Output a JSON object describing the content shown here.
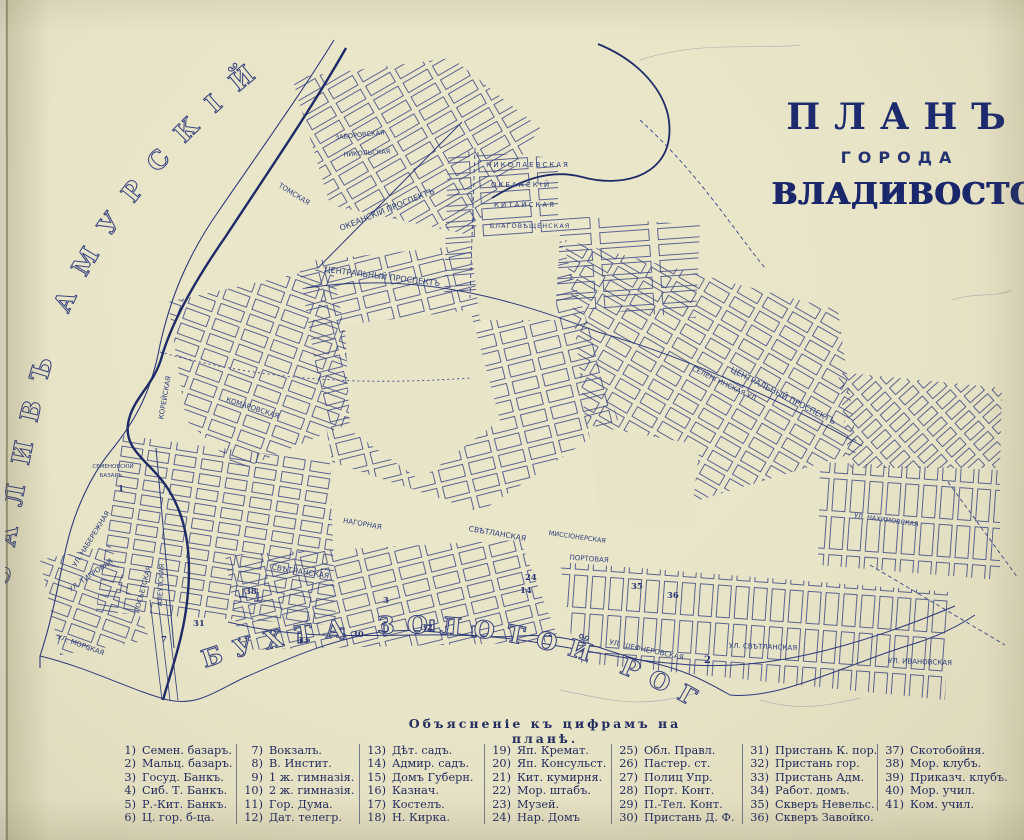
{
  "title": {
    "plan": "ПЛАНЪ",
    "goroda": "ГОРОДА",
    "city": "ВЛАДИВОСТОКА"
  },
  "colors": {
    "paper": "#e8e4c7",
    "ink": "#2e3a7a",
    "ink_dark": "#1f2b66"
  },
  "water": {
    "amur_bay": "ЗАЛИВЪ  АМУРСКІЙ",
    "golden_horn": "БУХТА  ЗОЛОТОЙ  РОГЪ"
  },
  "map": {
    "streets": [
      "ОКЕАНСКІЙ ПРОСПЕКТЪ",
      "ЦЕНТРАЛЬНЫЙ ПРОСПЕКТЪ",
      "СВѢТЛАНСКАЯ",
      "УЛ. СВѢТЛАНСКАЯ",
      "АЛЕУТСКАЯ",
      "КОРЕЙСКАЯ",
      "УЛ. НАБЕРЕЖНАЯ",
      "УЛ. ТИГРОВАЯ",
      "ПОСЬЕТСКАЯ",
      "КОМАРОВСКАЯ",
      "ТОМСКАЯ",
      "КИТАЙСКАЯ",
      "НИКОЛАЕВСКАЯ",
      "ОКЕАНСКІЙ",
      "БЛАГОВѢЩЕНСКАЯ",
      "ЗАБОРОВСКАЯ",
      "НИКОЛЬСКАЯ",
      "СЕЛЕНГИНСКАЯ УЛ.",
      "ПОРТОВАЯ",
      "НАГОРНАЯ",
      "МИССІОНЕРСКАЯ",
      "УЛ. ШЕФНЕРОВСКАЯ",
      "УЛ. ИВАНОВСКАЯ",
      "УЛ. МОРСКАЯ",
      "СЕМЕНОВСКІЙ",
      "БАЗАРЪ",
      "УЛ. НАХИМОВСКАЯ"
    ],
    "markers": [
      "1",
      "2",
      "3",
      "7",
      "14",
      "24",
      "30",
      "31",
      "32",
      "33",
      "35",
      "36",
      "38"
    ]
  },
  "legend": {
    "heading": "Объясненіе къ цифрамъ на планѣ.",
    "items": [
      {
        "n": "1)",
        "t": "Семен. базаръ."
      },
      {
        "n": "2)",
        "t": "Мальц. базаръ."
      },
      {
        "n": "3)",
        "t": "Госуд. Банкъ."
      },
      {
        "n": "4)",
        "t": "Сиб. Т. Банкъ."
      },
      {
        "n": "5)",
        "t": "Р.-Кит. Банкъ."
      },
      {
        "n": "6)",
        "t": "Ц. гор. б-ца."
      },
      {
        "n": "7)",
        "t": "Вокзалъ."
      },
      {
        "n": "8)",
        "t": "В. Инстит."
      },
      {
        "n": "9)",
        "t": "1 ж. гимназія."
      },
      {
        "n": "10)",
        "t": "2 ж. гимназія."
      },
      {
        "n": "11)",
        "t": "Гор. Дума."
      },
      {
        "n": "12)",
        "t": "Дат. телегр."
      },
      {
        "n": "13)",
        "t": "Дѣт. садъ."
      },
      {
        "n": "14)",
        "t": "Адмир. садъ."
      },
      {
        "n": "15)",
        "t": "Домъ Губерн."
      },
      {
        "n": "16)",
        "t": "Казнач."
      },
      {
        "n": "17)",
        "t": "Костелъ."
      },
      {
        "n": "18)",
        "t": "Н. Кирка."
      },
      {
        "n": "19)",
        "t": "Яп. Кремат."
      },
      {
        "n": "20)",
        "t": "Яп. Консульст."
      },
      {
        "n": "21)",
        "t": "Кит. кумирня."
      },
      {
        "n": "22)",
        "t": "Мор. штабъ."
      },
      {
        "n": "23)",
        "t": "Музей."
      },
      {
        "n": "24)",
        "t": "Нар. Домъ"
      },
      {
        "n": "25)",
        "t": "Обл. Правл."
      },
      {
        "n": "26)",
        "t": "Пастер. ст."
      },
      {
        "n": "27)",
        "t": "Полиц Упр."
      },
      {
        "n": "28)",
        "t": "Порт. Конт."
      },
      {
        "n": "29)",
        "t": "П.-Тел. Конт."
      },
      {
        "n": "30)",
        "t": "Пристань Д. Ф."
      },
      {
        "n": "31)",
        "t": "Пристань К. пор."
      },
      {
        "n": "32)",
        "t": "Пристань гор."
      },
      {
        "n": "33)",
        "t": "Пристань Адм."
      },
      {
        "n": "34)",
        "t": "Работ. домъ."
      },
      {
        "n": "35)",
        "t": "Скверъ Невельс."
      },
      {
        "n": "36)",
        "t": "Скверъ Завойко."
      },
      {
        "n": "37)",
        "t": "Скотобойня."
      },
      {
        "n": "38)",
        "t": "Мор. клубъ."
      },
      {
        "n": "39)",
        "t": "Приказч. клубъ."
      },
      {
        "n": "40)",
        "t": "Мор. учил."
      },
      {
        "n": "41)",
        "t": "Ком. учил."
      }
    ]
  }
}
